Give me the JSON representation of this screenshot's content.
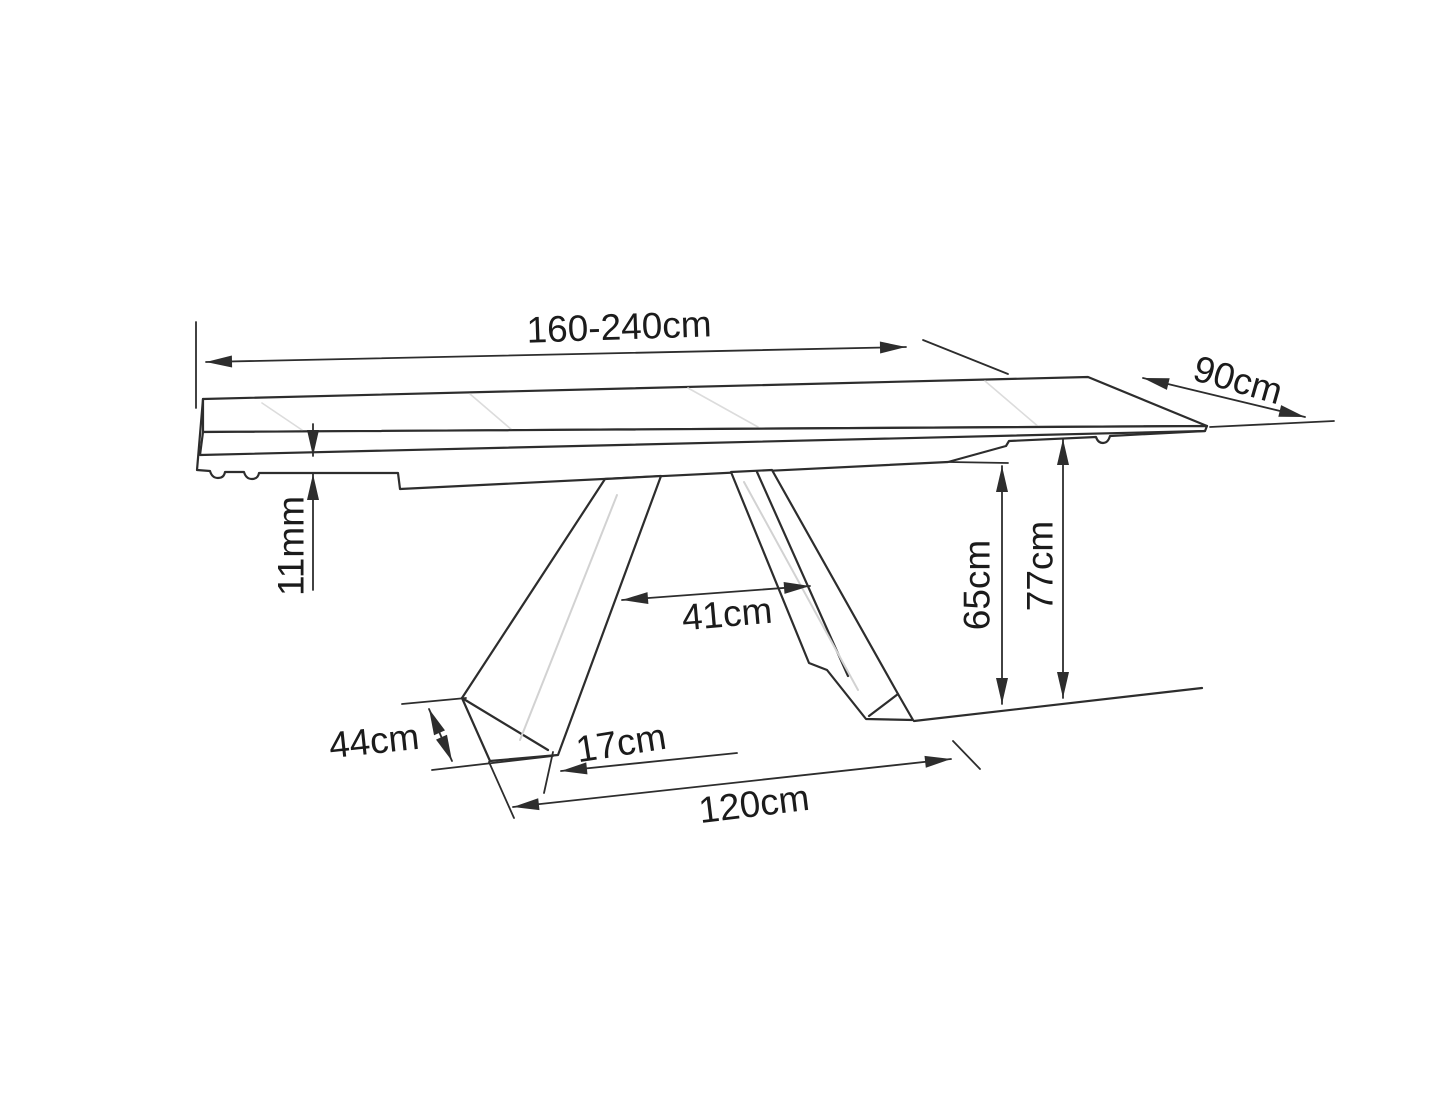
{
  "colors": {
    "background": "#ffffff",
    "line": "#2d2d2d",
    "text": "#1b1b1b",
    "shading": "#d2d2d2"
  },
  "labels": {
    "length": "160-240cm",
    "depth": "90cm",
    "top_thickness": "11mm",
    "leg_gap": "41cm",
    "underside_clearance": "65cm",
    "total_height": "77cm",
    "foot_width": "44cm",
    "foot_length": "17cm",
    "base_length": "120cm"
  }
}
